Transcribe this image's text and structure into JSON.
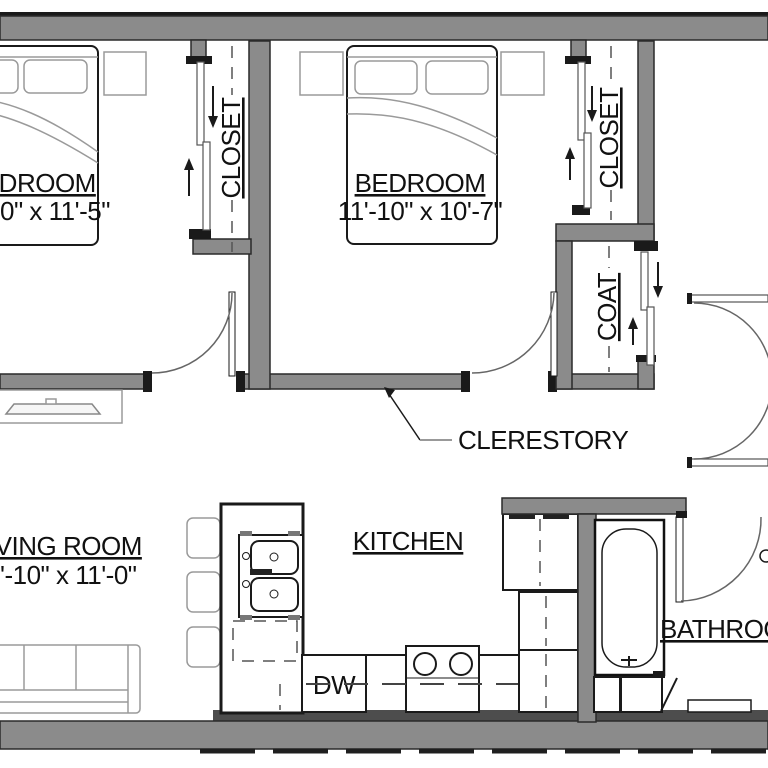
{
  "plan_type": "apartment-floor-plan",
  "colors": {
    "wall_fill": "#8b8b8b",
    "wall_edge": "#2a2a2a",
    "line_black": "#1a1a1a",
    "furniture_light": "#9a9a9a",
    "dash_line": "#555555",
    "plinth": "#4d4d4d",
    "text": "#111111",
    "background": "#ffffff"
  },
  "labels": {
    "bedroom1": {
      "name": "BEDROOM",
      "dims": "0\" x 11'-5\""
    },
    "bedroom2": {
      "name": "BEDROOM",
      "dims": "11'-10\" x 10'-7\""
    },
    "closet1": "CLOSET",
    "closet2": "CLOSET",
    "coat": "COAT",
    "living": {
      "name": "LIVING ROOM",
      "dims": "'-10\" x 11'-0\""
    },
    "kitchen": "KITCHEN",
    "bathroom": "BATHROOM",
    "dishwasher": "DW",
    "clerestory": "CLERESTORY"
  }
}
